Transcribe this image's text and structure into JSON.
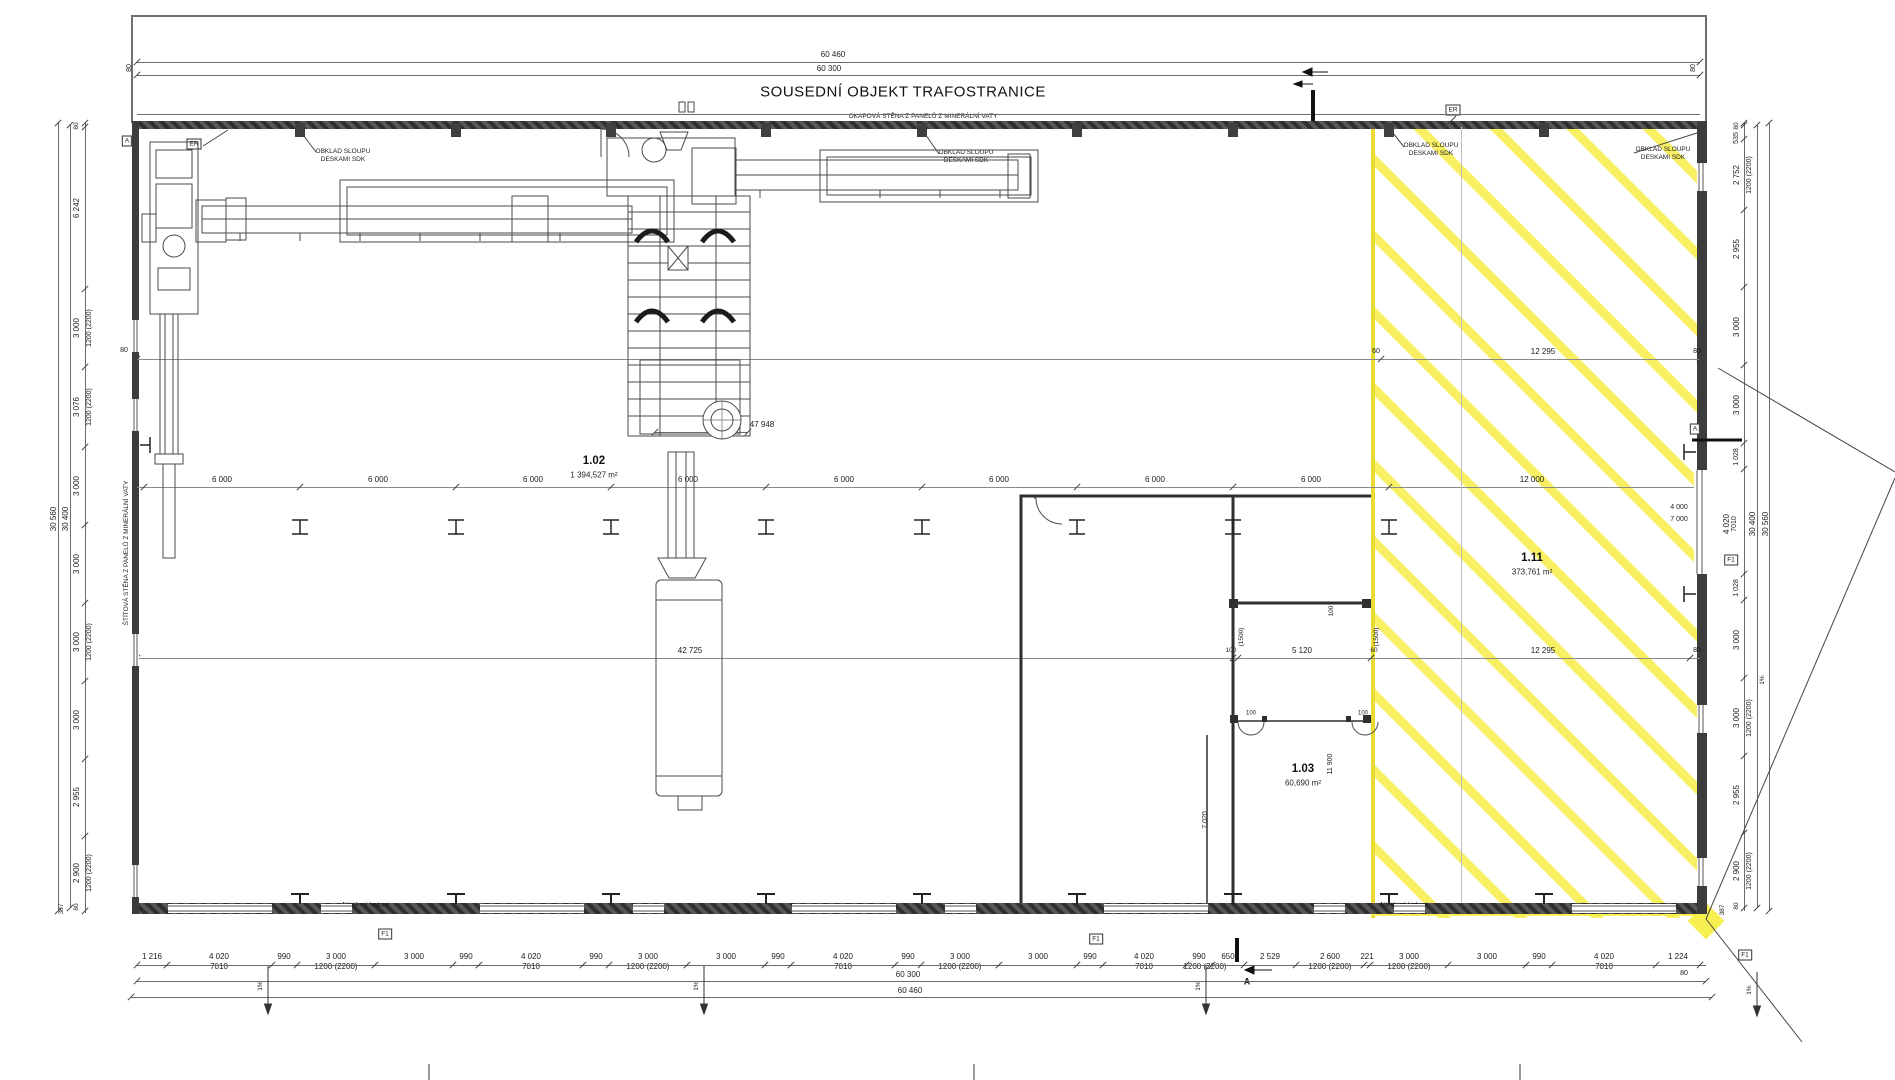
{
  "title": "SOUSEDNÍ OBJEKT TRAFOSTRANICE",
  "colors": {
    "highlight_yellow": "#f7ee46",
    "linework": "#4a4a4a",
    "wall": "#3c3c3c"
  },
  "rooms": [
    {
      "number": "1.02",
      "area": "1 394,527 m²",
      "x": 594,
      "y": 461
    },
    {
      "number": "1.03",
      "area": "60,690 m²",
      "x": 1303,
      "y": 769
    },
    {
      "number": "1.11",
      "area": "373,761 m²",
      "x": 1532,
      "y": 558
    }
  ],
  "texts": [
    {
      "t": "60 460",
      "x": 833,
      "y": 55
    },
    {
      "t": "60 300",
      "x": 829,
      "y": 69
    },
    {
      "t": "80",
      "x": 130,
      "y": 68,
      "r": -90,
      "s": 7
    },
    {
      "t": "80",
      "x": 1694,
      "y": 68,
      "r": -90,
      "s": 7
    },
    {
      "t": "OKAPOVÁ STĚNA Z PANELŮ Z MINERÁLNÍ VATY",
      "x": 923,
      "y": 117,
      "s": 6.5,
      "n": "eaves-wall-label"
    },
    {
      "t": "OBKLAD SLOUPU\nDESKAMI SDK",
      "x": 343,
      "y": 156,
      "s": 6.5,
      "n": "column-cladding-label"
    },
    {
      "t": "OBKLAD SLOUPU\nDESKAMI SDK",
      "x": 966,
      "y": 157,
      "s": 6.5,
      "n": "column-cladding-label"
    },
    {
      "t": "OBKLAD SLOUPU\nDESKAMI SDK",
      "x": 1431,
      "y": 150,
      "s": 6.5,
      "n": "column-cladding-label"
    },
    {
      "t": "OBKLAD SLOUPU\nDESKAMI SDK",
      "x": 1663,
      "y": 154,
      "s": 6.5,
      "n": "column-cladding-label"
    },
    {
      "t": "ŠTÍTOVÁ STĚNA Z PANELŮ Z MINERÁLNÍ VATY",
      "x": 127,
      "y": 553,
      "r": -90,
      "s": 6.5,
      "n": "gable-wall-label"
    },
    {
      "t": "80",
      "x": 124,
      "y": 351,
      "s": 7
    },
    {
      "t": "60",
      "x": 1376,
      "y": 352,
      "s": 7
    },
    {
      "t": "12 295",
      "x": 1543,
      "y": 352
    },
    {
      "t": "80",
      "x": 1697,
      "y": 352,
      "s": 7
    },
    {
      "t": "47 948",
      "x": 762,
      "y": 425
    },
    {
      "t": "6 000",
      "x": 222,
      "y": 480
    },
    {
      "t": "6 000",
      "x": 378,
      "y": 480
    },
    {
      "t": "6 000",
      "x": 533,
      "y": 480
    },
    {
      "t": "6 000",
      "x": 688,
      "y": 480
    },
    {
      "t": "6 000",
      "x": 844,
      "y": 480
    },
    {
      "t": "6 000",
      "x": 999,
      "y": 480
    },
    {
      "t": "6 000",
      "x": 1155,
      "y": 480
    },
    {
      "t": "6 000",
      "x": 1311,
      "y": 480
    },
    {
      "t": "12 000",
      "x": 1532,
      "y": 480
    },
    {
      "t": "4 000",
      "x": 1679,
      "y": 508,
      "s": 7
    },
    {
      "t": "7 000",
      "x": 1679,
      "y": 520,
      "s": 7
    },
    {
      "t": "42 725",
      "x": 690,
      "y": 651
    },
    {
      "t": "100",
      "x": 1231,
      "y": 651,
      "s": 6.5
    },
    {
      "t": "5 120",
      "x": 1302,
      "y": 651
    },
    {
      "t": "60",
      "x": 1374,
      "y": 651,
      "s": 6.5
    },
    {
      "t": "12 295",
      "x": 1543,
      "y": 651
    },
    {
      "t": "80",
      "x": 1697,
      "y": 651,
      "s": 7
    },
    {
      "t": "100",
      "x": 1332,
      "y": 611,
      "r": -90,
      "s": 6.5
    },
    {
      "t": "(1500)",
      "x": 1242,
      "y": 637,
      "r": -90,
      "s": 6.5
    },
    {
      "t": "(1500)",
      "x": 1377,
      "y": 637,
      "r": -90,
      "s": 6.5
    },
    {
      "t": "11 900",
      "x": 1331,
      "y": 764,
      "r": -90,
      "s": 7
    },
    {
      "t": "7 020",
      "x": 1206,
      "y": 820,
      "r": -90,
      "s": 7
    },
    {
      "t": "100",
      "x": 1251,
      "y": 714,
      "s": 6
    },
    {
      "t": "100",
      "x": 1363,
      "y": 714,
      "s": 6
    },
    {
      "t": "1 216",
      "x": 152,
      "y": 957
    },
    {
      "t": "4 020",
      "x": 219,
      "y": 957
    },
    {
      "t": "990",
      "x": 284,
      "y": 957
    },
    {
      "t": "3 000",
      "x": 336,
      "y": 957
    },
    {
      "t": "3 000",
      "x": 414,
      "y": 957
    },
    {
      "t": "990",
      "x": 466,
      "y": 957
    },
    {
      "t": "4 020",
      "x": 531,
      "y": 957
    },
    {
      "t": "990",
      "x": 596,
      "y": 957
    },
    {
      "t": "3 000",
      "x": 648,
      "y": 957
    },
    {
      "t": "3 000",
      "x": 726,
      "y": 957
    },
    {
      "t": "990",
      "x": 778,
      "y": 957
    },
    {
      "t": "4 020",
      "x": 843,
      "y": 957
    },
    {
      "t": "990",
      "x": 908,
      "y": 957
    },
    {
      "t": "3 000",
      "x": 960,
      "y": 957
    },
    {
      "t": "3 000",
      "x": 1038,
      "y": 957
    },
    {
      "t": "990",
      "x": 1090,
      "y": 957
    },
    {
      "t": "4 020",
      "x": 1144,
      "y": 957
    },
    {
      "t": "990",
      "x": 1199,
      "y": 957
    },
    {
      "t": "650",
      "x": 1228,
      "y": 957
    },
    {
      "t": "2 529",
      "x": 1270,
      "y": 957
    },
    {
      "t": "2 600",
      "x": 1330,
      "y": 957
    },
    {
      "t": "221",
      "x": 1367,
      "y": 957
    },
    {
      "t": "3 000",
      "x": 1409,
      "y": 957
    },
    {
      "t": "3 000",
      "x": 1487,
      "y": 957
    },
    {
      "t": "990",
      "x": 1539,
      "y": 957
    },
    {
      "t": "4 020",
      "x": 1604,
      "y": 957
    },
    {
      "t": "1 224",
      "x": 1678,
      "y": 957
    },
    {
      "t": "7010",
      "x": 219,
      "y": 967
    },
    {
      "t": "7010",
      "x": 531,
      "y": 967
    },
    {
      "t": "7010",
      "x": 843,
      "y": 967
    },
    {
      "t": "7010",
      "x": 1144,
      "y": 967
    },
    {
      "t": "7010",
      "x": 1604,
      "y": 967
    },
    {
      "t": "1200 (2200)",
      "x": 336,
      "y": 967
    },
    {
      "t": "1200 (2200)",
      "x": 648,
      "y": 967
    },
    {
      "t": "1200 (2200)",
      "x": 960,
      "y": 967
    },
    {
      "t": "1200 (2200)",
      "x": 1205,
      "y": 967
    },
    {
      "t": "1200 (2200)",
      "x": 1330,
      "y": 967
    },
    {
      "t": "1200 (2200)",
      "x": 1409,
      "y": 967
    },
    {
      "t": "80",
      "x": 1684,
      "y": 974,
      "s": 7
    },
    {
      "t": "60 300",
      "x": 908,
      "y": 975
    },
    {
      "t": "60 460",
      "x": 910,
      "y": 991
    },
    {
      "t": "1%",
      "x": 261,
      "y": 986,
      "r": -90,
      "s": 6.5
    },
    {
      "t": "1%",
      "x": 697,
      "y": 986,
      "r": -90,
      "s": 6.5
    },
    {
      "t": "1%",
      "x": 1199,
      "y": 986,
      "r": -90,
      "s": 6.5
    },
    {
      "t": "1%",
      "x": 1750,
      "y": 990,
      "r": -90,
      "s": 6.5
    },
    {
      "t": "1%",
      "x": 1763,
      "y": 680,
      "r": -90,
      "s": 6.5
    },
    {
      "t": "80",
      "x": 77,
      "y": 126,
      "r": -90,
      "s": 6.5
    },
    {
      "t": "6 242",
      "x": 77,
      "y": 208,
      "r": -90
    },
    {
      "t": "3 000",
      "x": 77,
      "y": 328,
      "r": -90
    },
    {
      "t": "3 076",
      "x": 77,
      "y": 407,
      "r": -90
    },
    {
      "t": "3 000",
      "x": 77,
      "y": 486,
      "r": -90
    },
    {
      "t": "3 000",
      "x": 77,
      "y": 564,
      "r": -90
    },
    {
      "t": "3 000",
      "x": 77,
      "y": 642,
      "r": -90
    },
    {
      "t": "3 000",
      "x": 77,
      "y": 720,
      "r": -90
    },
    {
      "t": "2 955",
      "x": 77,
      "y": 797,
      "r": -90
    },
    {
      "t": "2 900",
      "x": 77,
      "y": 873,
      "r": -90
    },
    {
      "t": "80",
      "x": 77,
      "y": 907,
      "r": -90,
      "s": 6.5
    },
    {
      "t": "387",
      "x": 62,
      "y": 909,
      "r": -90,
      "s": 6.5
    },
    {
      "t": "1200 (2200)",
      "x": 90,
      "y": 328,
      "r": -90,
      "s": 7
    },
    {
      "t": "1200 (2200)",
      "x": 90,
      "y": 407,
      "r": -90,
      "s": 7
    },
    {
      "t": "1200 (2200)",
      "x": 90,
      "y": 642,
      "r": -90,
      "s": 7
    },
    {
      "t": "1200 (2200)",
      "x": 90,
      "y": 873,
      "r": -90,
      "s": 7
    },
    {
      "t": "30 560",
      "x": 54,
      "y": 519,
      "r": -90
    },
    {
      "t": "30 400",
      "x": 66,
      "y": 519,
      "r": -90
    },
    {
      "t": "80",
      "x": 1737,
      "y": 126,
      "r": -90,
      "s": 6.5
    },
    {
      "t": "535",
      "x": 1737,
      "y": 138,
      "r": -90,
      "s": 7
    },
    {
      "t": "2 752",
      "x": 1737,
      "y": 175,
      "r": -90
    },
    {
      "t": "2 955",
      "x": 1737,
      "y": 249,
      "r": -90
    },
    {
      "t": "3 000",
      "x": 1737,
      "y": 327,
      "r": -90
    },
    {
      "t": "3 000",
      "x": 1737,
      "y": 405,
      "r": -90
    },
    {
      "t": "1 028",
      "x": 1737,
      "y": 457,
      "r": -90,
      "s": 7
    },
    {
      "t": "1 028",
      "x": 1737,
      "y": 588,
      "r": -90,
      "s": 7
    },
    {
      "t": "3 000",
      "x": 1737,
      "y": 640,
      "r": -90
    },
    {
      "t": "3 000",
      "x": 1737,
      "y": 718,
      "r": -90
    },
    {
      "t": "2 955",
      "x": 1737,
      "y": 795,
      "r": -90
    },
    {
      "t": "2 900",
      "x": 1737,
      "y": 871,
      "r": -90
    },
    {
      "t": "80",
      "x": 1737,
      "y": 906,
      "r": -90,
      "s": 6.5
    },
    {
      "t": "387",
      "x": 1723,
      "y": 910,
      "r": -90,
      "s": 6.5
    },
    {
      "t": "1200 (2200)",
      "x": 1750,
      "y": 175,
      "r": -90,
      "s": 7
    },
    {
      "t": "1200 (2200)",
      "x": 1750,
      "y": 718,
      "r": -90,
      "s": 7
    },
    {
      "t": "1200 (2200)",
      "x": 1750,
      "y": 871,
      "r": -90,
      "s": 7
    },
    {
      "t": "4 020",
      "x": 1727,
      "y": 524,
      "r": -90
    },
    {
      "t": "7010",
      "x": 1735,
      "y": 524,
      "r": -90,
      "s": 7
    },
    {
      "t": "30 400",
      "x": 1753,
      "y": 524,
      "r": -90
    },
    {
      "t": "30 560",
      "x": 1766,
      "y": 524,
      "r": -90
    },
    {
      "t": "Nástěnný hydrant",
      "x": 366,
      "y": 906,
      "s": 6,
      "n": "hydrant-label"
    },
    {
      "t": "Nástěnný hydrant",
      "x": 1404,
      "y": 906,
      "s": 6,
      "n": "hydrant-label"
    },
    {
      "t": "A",
      "x": 1247,
      "y": 982,
      "s": 9,
      "b": 1,
      "n": "section-mark-label"
    }
  ],
  "boxes": [
    {
      "t": "A",
      "x": 127,
      "y": 141,
      "n": "section-marker"
    },
    {
      "t": "ER",
      "x": 194,
      "y": 144,
      "n": "er-marker"
    },
    {
      "t": "ER",
      "x": 1453,
      "y": 110,
      "n": "er-marker"
    },
    {
      "t": "A",
      "x": 1695,
      "y": 429,
      "n": "section-marker"
    },
    {
      "t": "F1",
      "x": 385,
      "y": 934,
      "n": "f1-marker"
    },
    {
      "t": "F1",
      "x": 1096,
      "y": 939,
      "n": "f1-marker"
    },
    {
      "t": "F1",
      "x": 1731,
      "y": 560,
      "n": "f1-marker"
    },
    {
      "t": "F1",
      "x": 1745,
      "y": 955,
      "n": "f1-marker"
    }
  ],
  "chains": {
    "h": [
      {
        "y": 62,
        "x1": 137,
        "x2": 1700,
        "t": [
          137,
          1700
        ]
      },
      {
        "y": 75,
        "x1": 137,
        "x2": 1700,
        "t": [
          137,
          1700
        ]
      },
      {
        "y": 114,
        "x1": 137,
        "x2": 1700,
        "t": []
      },
      {
        "y": 359,
        "x1": 137,
        "x2": 1700,
        "t": [
          137,
          1381,
          1700
        ],
        "c": "#8a8a8a"
      },
      {
        "y": 487,
        "x1": 137,
        "x2": 1700,
        "t": [
          144,
          300,
          456,
          611,
          766,
          922,
          1077,
          1233,
          1389,
          1700
        ],
        "c": "#8a8a8a"
      },
      {
        "y": 658,
        "x1": 137,
        "x2": 1700,
        "t": [
          137,
          1233,
          1238,
          1371,
          1690
        ],
        "c": "#8a8a8a"
      },
      {
        "y": 432,
        "x1": 655,
        "x2": 748,
        "t": [
          655,
          748
        ]
      },
      {
        "y": 965,
        "x1": 137,
        "x2": 1706,
        "t": [
          137,
          167,
          272,
          297,
          375,
          453,
          479,
          583,
          609,
          687,
          765,
          791,
          895,
          921,
          999,
          1077,
          1103,
          1186,
          1212,
          1244,
          1296,
          1364,
          1370,
          1448,
          1526,
          1552,
          1656,
          1700
        ]
      },
      {
        "y": 981,
        "x1": 137,
        "x2": 1706,
        "t": [
          137,
          1706
        ]
      },
      {
        "y": 997,
        "x1": 131,
        "x2": 1712,
        "t": [
          131,
          1712
        ]
      }
    ],
    "v": [
      {
        "x": 58,
        "y1": 123,
        "y2": 911,
        "t": [
          123,
          911
        ]
      },
      {
        "x": 70,
        "y1": 125,
        "y2": 908,
        "t": [
          125,
          908
        ]
      },
      {
        "x": 85,
        "y1": 123,
        "y2": 913,
        "t": [
          123,
          127,
          289,
          367,
          447,
          525,
          603,
          681,
          759,
          836,
          911
        ]
      },
      {
        "x": 1744,
        "y1": 123,
        "y2": 911,
        "t": [
          123,
          125,
          139,
          210,
          287,
          365,
          443,
          469,
          574,
          600,
          678,
          756,
          833,
          908
        ]
      },
      {
        "x": 1757,
        "y1": 125,
        "y2": 908,
        "t": [
          125,
          908
        ]
      },
      {
        "x": 1769,
        "y1": 123,
        "y2": 911,
        "t": [
          123,
          911
        ]
      },
      {
        "x": 1461,
        "y1": 127,
        "y2": 902,
        "t": [],
        "c": "#bdbdbd"
      }
    ]
  }
}
